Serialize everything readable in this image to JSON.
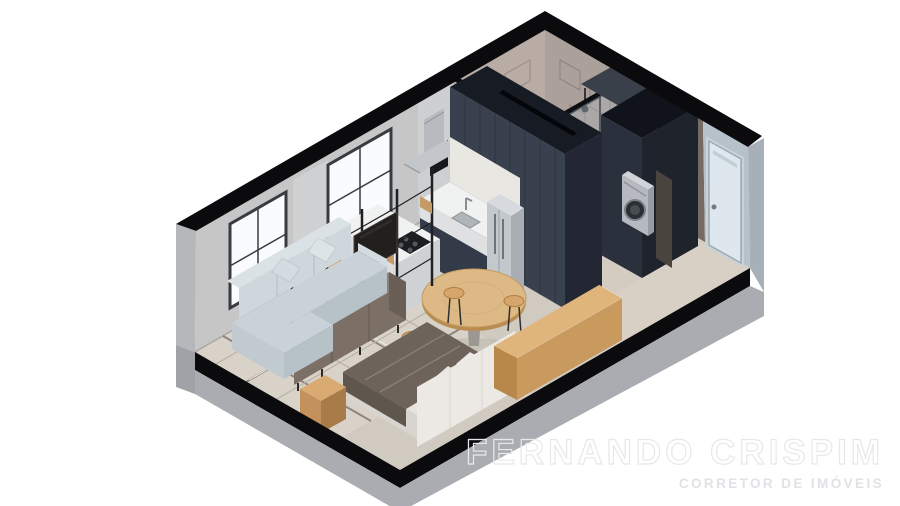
{
  "watermark": {
    "title": "FERNANDO CRISPIM",
    "subtitle": "CORRETOR DE IMÓVEIS"
  },
  "scene": {
    "type": "isometric-apartment-cutaway-render",
    "background": "#ffffff",
    "objects": [
      "sofa",
      "throw-pillows",
      "shelving-divider",
      "tv-panel",
      "sideboard",
      "rug",
      "double-bed",
      "headboard",
      "blanket",
      "nightstand",
      "wooden-bench",
      "round-dining-table",
      "dining-stools",
      "kitchen-island",
      "gas-cooktop",
      "bar-stools",
      "kitchen-cabinet-block",
      "counter-with-sink",
      "refrigerator",
      "range-hood",
      "windows",
      "bathroom-tiled-walls",
      "shower-glass",
      "shower-head",
      "washing-machine",
      "laundry-cabinet",
      "wardrobe-closet",
      "entry-door",
      "floor-slab-skirt"
    ],
    "palette": {
      "background": "#ffffff",
      "wall_top_cut": "#0b0b0d",
      "wall_concrete": "#c6c6c7",
      "wall_pale_blue": "#b7c1c9",
      "bathroom_tile": "#b8aca5",
      "cabinet_navy": "#39414e",
      "cabinet_navy_dark": "#222733",
      "counter_white": "#f0f1f1",
      "steel": "#c3c8cd",
      "wood_light": "#d9ab72",
      "wood_bench": "#e0b57c",
      "sofa_gray_blue": "#c9d2d8",
      "blanket_taupe": "#6e635a",
      "floor_main": "#d0cac1",
      "floor_bathroom": "#3a3431",
      "floor_entry": "#d8d0c5",
      "rug": "#d8d2c8",
      "skirt_gray": "#a9acb0",
      "glass": "#4e575f",
      "watermark_text": "#e8e8eb"
    }
  }
}
